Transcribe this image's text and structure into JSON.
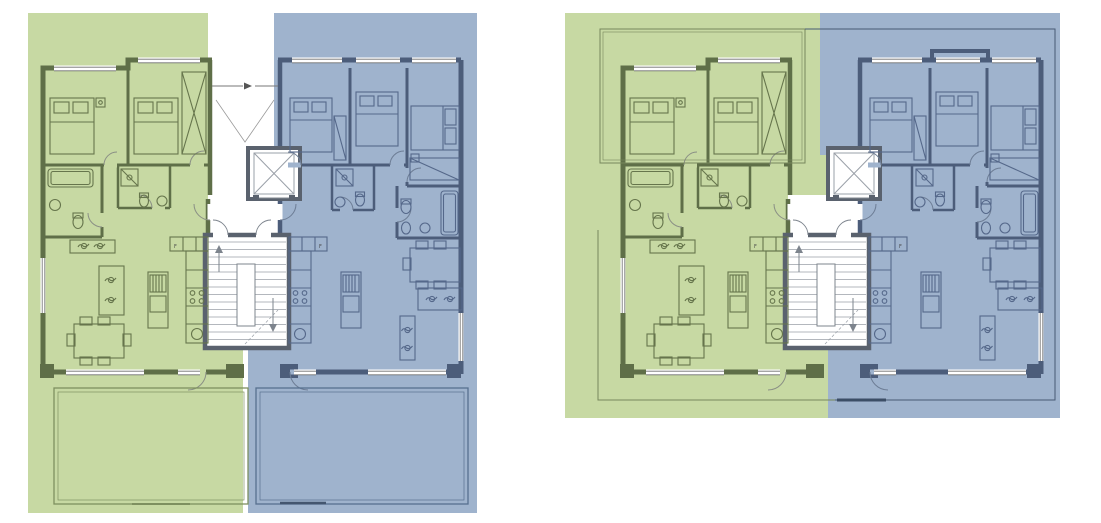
{
  "canvas": {
    "width": 1101,
    "height": 523,
    "background": "#ffffff"
  },
  "figure": {
    "type": "architectural-floor-plan-pair",
    "description": "Two residential floor plans side by side. Each floor holds two apartments around a shared central core: a green-tinted unit on the left and a blue-tinted unit on the right.",
    "plans": [
      {
        "id": "floor-plan-left",
        "position": "left",
        "features": [
          "entrance corridor at top of core",
          "two large private terraces below the building",
          "colour tint runs full height of the lot"
        ]
      },
      {
        "id": "floor-plan-right",
        "position": "right",
        "features": [
          "upper floor variant",
          "thin roof-eave outlines around the building",
          "no terraces",
          "colour tint stops below the building"
        ]
      }
    ],
    "shared_core": {
      "rooms": [
        "entrance corridor",
        "elevator",
        "vestibule",
        "two-flight staircase"
      ]
    },
    "units": [
      {
        "id": "unit-green",
        "side": "left",
        "tint": "#c7d9a3",
        "wall": "#5f6f48",
        "rooms": [
          "bedroom 1",
          "bedroom 2",
          "bathroom with bathtub",
          "shower room",
          "hall",
          "open kitchen / living / dining room",
          "terrace (left plan only)"
        ]
      },
      {
        "id": "unit-blue",
        "side": "right",
        "tint": "#9fb3cd",
        "wall": "#4c5d7a",
        "rooms": [
          "bedroom 1",
          "bedroom 2",
          "bedroom 3",
          "shower room",
          "bathroom with bathtub",
          "hall",
          "open kitchen / living / dining room",
          "terrace (left plan only)"
        ]
      }
    ],
    "furniture_icons": [
      "double-bed-icon",
      "wardrobe-icon",
      "dining-table-six-chairs-icon",
      "sofa-icon",
      "tv-bench-icon",
      "kitchen-island-icon",
      "kitchen-counter-icon",
      "cooktop-icon",
      "sink-icon",
      "fridge-icon",
      "bathtub-icon",
      "shower-icon",
      "toilet-icon",
      "washbasin-icon",
      "elevator-icon",
      "staircase-icon",
      "plant-icon"
    ]
  },
  "labels": {
    "fridge": "F"
  },
  "colors": {
    "unit_a_fill": "#c7d9a3",
    "unit_a_wall": "#5f6f48",
    "unit_a_furniture": "#66754c",
    "unit_b_fill": "#9fb3cd",
    "unit_b_wall": "#4c5d7a",
    "unit_b_furniture": "#55688a",
    "core_wall": "#5a626e",
    "core_lines": "#9aa0a8",
    "white": "#ffffff",
    "terrace_line_green": "#7e9060",
    "terrace_line_blue": "#57708f",
    "roof_line_green": "#77875c",
    "roof_line_blue": "#475a73"
  }
}
